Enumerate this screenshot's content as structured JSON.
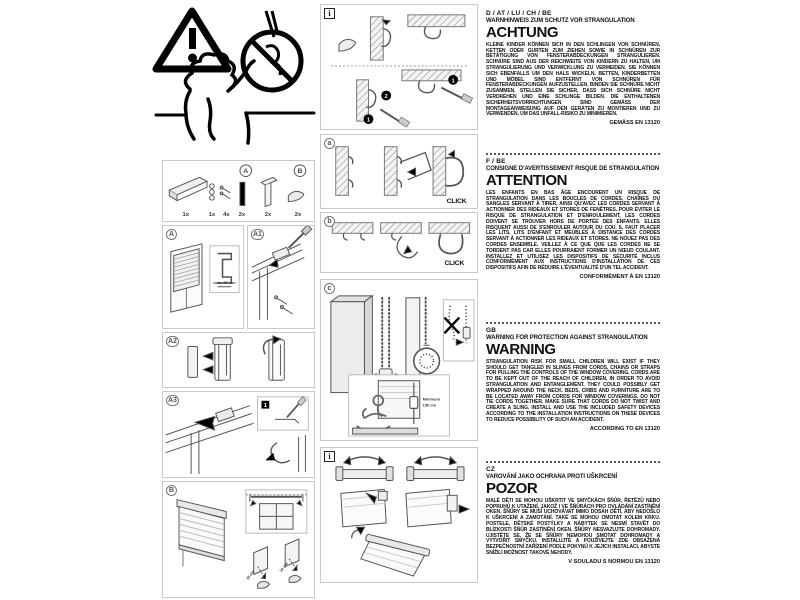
{
  "illustrations": {
    "parts": {
      "label_a": "A",
      "label_b": "B",
      "quantities": [
        "1x",
        "1x",
        "4x",
        "2x",
        "2x",
        "2x"
      ]
    },
    "panel_a": {
      "label": "A",
      "max_depth": "max. 25 mm"
    },
    "panel_a1": {
      "label": "A1"
    },
    "panel_a2": {
      "label": "A2"
    },
    "panel_a3": {
      "label": "A3",
      "step": "1"
    },
    "panel_b": {
      "label": "B",
      "measure_left": "10 cm",
      "measure_right": "10 cm"
    },
    "panel_info_top": {
      "label": "i",
      "step1": "1",
      "step2": "2"
    },
    "panel_wall_click": {
      "label": "a",
      "click": "CLICK"
    },
    "panel_ceiling_click": {
      "label": "b",
      "click": "CLICK"
    },
    "panel_child_safety": {
      "label": "c",
      "minimum_line1": "Minimum",
      "minimum_line2": "150 cm"
    },
    "panel_info_bottom": {
      "label": "i"
    }
  },
  "sections": [
    {
      "code": "D / AT / LU / CH / BE",
      "subtitle": "WARNHINWEIS ZUM SCHUTZ VOR STRANGULATION",
      "title": "ACHTUNG",
      "body": "KLEINE KINDER KÖNNEN SICH IN DEN SCHLINGEN VON SCHNÜREN, KETTEN ODER GURTEN ZUM ZIEHEN SOWIE IN SCHNÜREN ZUR BETÄTIGUNG VON FENSTERABDECKUNGEN STRANGULIEREN. SCHNÜRE SIND AUS DER REICHWEITE VON KINDERN ZU HALTEN, UM STRANGULIERUNG UND VERWICKLUNG ZU VERMEIDEN. SIE KÖNNEN SICH EBENFALLS UM DEN HALS WICKELN. BETTEN, KINDERBETTEN UND MÖBEL SIND ENTFERNT VON SCHNÜREN FÜR FENSTERABDECKUNGEN AUFZUSTELLEN. BINDEN SIE SCHNÜRE NICHT ZUSAMMEN. STELLEN SIE SICHER, DASS SICH SCHNÜRE NICHT VERDREHEN UND EINE SCHLINGE BILDEN. DIE ENTHALTENEN SICHERHEITSVORRICHTUNGEN SIND GEMÄSS DER MONTAGEANWEISUNG AUF DEN GERÄTEN ZU MONTIEREN UND ZU VERWENDEN, UM DAS UNFALL-RISIKO ZU MINIMIEREN.",
      "footer": "GEMÄSS EN 13120"
    },
    {
      "code": "F / BE",
      "subtitle": "CONSIGNE D'AVERTISSEMENT RISQUE DE STRANGULATION",
      "title": "ATTENTION",
      "body": "LES ENFANTS EN BAS ÂGE ENCOURENT UN RISQUE DE STRANGULATION DANS LES BOUCLES DE CORDES, CHAÎNES OU SANGLES SERVANT À TIRER, AINSI QU'AVEC LES CORDES SERVANT À ACTIONNER DES RIDEAUX ET STORES DE FENÊTRES. POUR ÉVITER LE RISQUE DE STRANGULATION ET D'ENROULEMENT, LES CORDES DOIVENT SE TROUVER HORS DE PORTÉE DES ENFANTS. ELLES RISQUENT AUSSI DE S'ENROULER AUTOUR DU COU. IL FAUT PLACER LES LITS, LITS D'ENFANT ET MEUBLES À DISTANCE DES CORDES SERVANT À ACTIONNER LES RIDEAUX ET STORES. NE NOUEZ PAS DES CORDES ENSEMBLE. VEILLEZ À CE QUE QUE LES CORDES NE SE TORDENT PAS CAR ELLES POURRAIENT FORMER UN NŒUD COULANT. INSTALLEZ ET UTILISEZ LES DISPOSITIFS DE SÉCURITÉ INCLUS CONFORMÉMENT AUX INSTRUCTIONS D'INSTALLATION DE CES DISPOSITIFS AFIN DE RÉDUIRE L'ÉVENTUALITÉ D'UN TEL ACCIDENT.",
      "footer": "CONFORMÉMENT À EN 13120"
    },
    {
      "code": "GB",
      "subtitle": "WARNING FOR PROTECTION AGAINST STRANGULATION",
      "title": "WARNING",
      "body": "STRANGULATION RISK FOR SMALL CHILDREN WILL EXIST IF THEY SHOULD GET TANGLED IN SLINGS FROM CORDS, CHAINS OR STRAPS FOR PULLING THE CONTROLS OF THE WINDOW COVERING. CORDS ARE TO BE KEPT OUT OF THE REACH OF CHILDREN, IN ORDER TO AVOID STRANGULATION AND ENTANGLEMENT. THEY COULD POSSIBLY GET WRAPPED AROUND THE NECK. BEDS, CRIBS AND FURNITURE ARE TO BE LOCATED AWAY FROM CORDS FOR WINDOW COVERINGS. DO NOT TIE CORDS TOGETHER. MAKE SURE THAT CORDS DO NOT TWIST AND CREATE A SLING. INSTALL AND USE THE INCLUDED SAFETY DEVICES ACCORDING TO THE INSTALLATION INSTRUCTIONS ON THESE DEVICES TO REDUCE POSSIBILITY OF SUCH AN ACCIDENT.",
      "footer": "ACCORDING TO EN 13120"
    },
    {
      "code": "CZ",
      "subtitle": "VAROVÁNÍ JAKO OCHRANA PROTI UŠKRCENÍ",
      "title": "POZOR",
      "body": "MALÉ DĚTI SE MOHOU UŠKRTIT VE SMYČKÁCH ŠŇŮR, ŘETĚZŮ NEBO POPRUHŮ K UTAŽENÍ, JAKOŽ I VE ŠŇŮRÁCH PRO OVLÁDÁNÍ ZASTÍNĚNÍ OKEN. ŠŇŮRY SE MUSÍ UCHOVÁVAT MIMO DOSAH DĚTÍ, ABY NEDOŠLO K UŠKRCENÍ A ZAMOTÁNÍ. TAKÉ SE MOHOU OMOTAT KOLEM KRKU. POSTELE, DĚTSKÉ POSTÝLKY A NÁBYTEK SE NESMÍ STAVĚT DO BLÍZKOSTI ŠŇŮR ZASTÍNĚNÍ OKEN. ŠŇŮRY NESVAZUJTE DOHROMADY. UJISTĚTE SE, ŽE SE ŠŇŮRY NEMOHOU SMOTAT DOHROMADY A VYTVOŘIT SMYČKU. INSTALUJTE A POUŽÍVEJTE ZDE OBSAŽENÁ BEZPEČNOSTNÍ ZAŘÍZENÍ PODLE POKYNŮ K JEJICH INSTALACI, ABYSTE SNÍŽILI MOŽNOST TAKOVÉ NEHODY.",
      "footer": "V SOULADU S NORMOU EN 13120"
    }
  ]
}
